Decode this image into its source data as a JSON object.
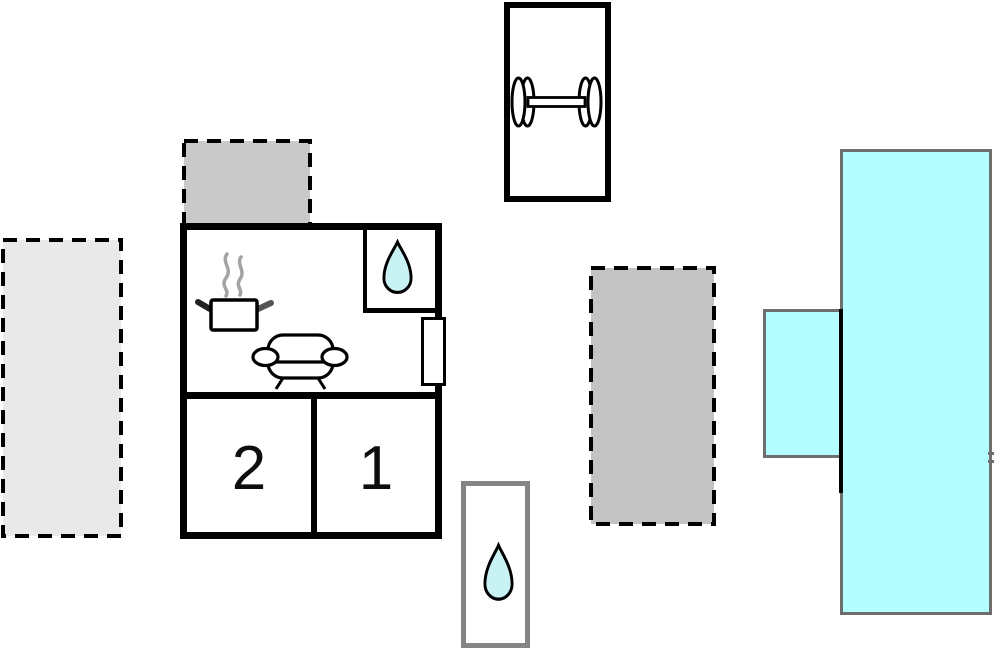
{
  "plan": {
    "type": "holiday-home floor plan",
    "rooms": {
      "bedroom_1": {
        "label": "1"
      },
      "bedroom_2": {
        "label": "2"
      }
    },
    "icons": {
      "fitness": "dumbbell-icon",
      "bathroom": "water-drop-icon",
      "outdoor_shower": "water-drop-icon",
      "kitchen": "cooking-pot-icon",
      "kitchen_steam": "steam-icon",
      "living_room": "sofa-icon"
    }
  },
  "colors": {
    "outline": "#000000",
    "pool_fill": "#b5feff",
    "pool_border": "#6e6e6e",
    "drop_fill": "#c9f2f4",
    "terrace_light": "#e9e9e9",
    "terrace_top": "#c9c9c9",
    "terrace_right": "#c3c3c3",
    "shower_border": "#848484",
    "steam": "#a3a3a3",
    "handle_dark": "#222222",
    "handle_gray": "#555555"
  }
}
